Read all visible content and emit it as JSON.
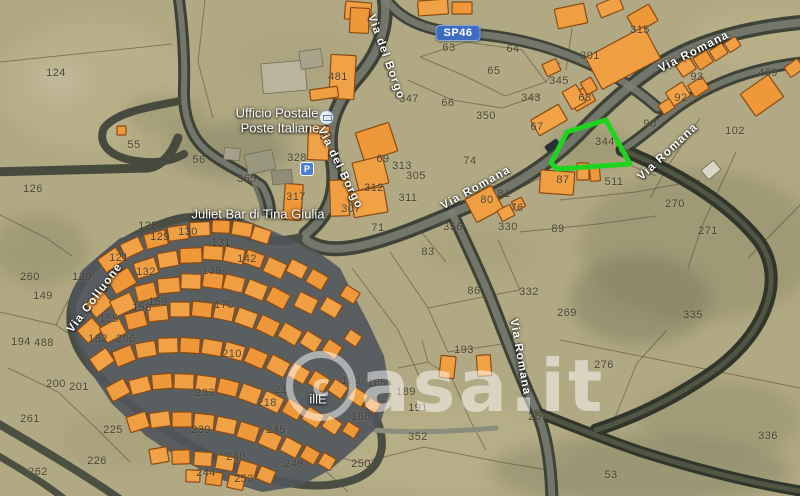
{
  "map": {
    "watermark": "casa.it",
    "route_badge": "SP46",
    "highlighted_parcel": "344",
    "parking_icon_letter": "P",
    "colors": {
      "terrain": "#b1a983",
      "road_dark": "#3f4337",
      "building_orange": "#f09e42",
      "building_outline": "#8a4a12",
      "highlight_green": "#1fd41f",
      "badge_blue": "#3c6cc2"
    },
    "poi_labels": [
      {
        "text": "Ufficio Postale",
        "x": 277,
        "y": 113
      },
      {
        "text": "Poste Italiane",
        "x": 280,
        "y": 128
      },
      {
        "text": "Juliet Bar di Tina Giulia",
        "x": 258,
        "y": 214
      },
      {
        "text": "illE",
        "x": 318,
        "y": 399
      }
    ],
    "street_labels": [
      {
        "text": "Via del Borgo",
        "x": 386,
        "y": 57,
        "rot": 70
      },
      {
        "text": "Via del Borgo",
        "x": 340,
        "y": 168,
        "rot": 64
      },
      {
        "text": "Via Romana",
        "x": 694,
        "y": 52,
        "rot": -27
      },
      {
        "text": "Via Romana",
        "x": 476,
        "y": 188,
        "rot": -29
      },
      {
        "text": "Via Romana",
        "x": 668,
        "y": 152,
        "rot": -43
      },
      {
        "text": "Via Romana",
        "x": 520,
        "y": 357,
        "rot": 80
      },
      {
        "text": "Via Colluone",
        "x": 95,
        "y": 298,
        "rot": -53
      }
    ],
    "parcel_labels": [
      {
        "n": "124",
        "x": 56,
        "y": 73
      },
      {
        "n": "55",
        "x": 134,
        "y": 145
      },
      {
        "n": "56",
        "x": 199,
        "y": 160
      },
      {
        "n": "126",
        "x": 33,
        "y": 189
      },
      {
        "n": "260",
        "x": 30,
        "y": 277
      },
      {
        "n": "149",
        "x": 43,
        "y": 296
      },
      {
        "n": "194",
        "x": 21,
        "y": 342
      },
      {
        "n": "488",
        "x": 44,
        "y": 343
      },
      {
        "n": "200",
        "x": 56,
        "y": 384
      },
      {
        "n": "201",
        "x": 79,
        "y": 387
      },
      {
        "n": "261",
        "x": 30,
        "y": 419
      },
      {
        "n": "225",
        "x": 113,
        "y": 430
      },
      {
        "n": "226",
        "x": 97,
        "y": 461
      },
      {
        "n": "262",
        "x": 38,
        "y": 472
      },
      {
        "n": "128",
        "x": 148,
        "y": 226
      },
      {
        "n": "129",
        "x": 160,
        "y": 237
      },
      {
        "n": "130",
        "x": 188,
        "y": 232
      },
      {
        "n": "131",
        "x": 221,
        "y": 243
      },
      {
        "n": "142",
        "x": 247,
        "y": 259
      },
      {
        "n": "121",
        "x": 119,
        "y": 258
      },
      {
        "n": "120",
        "x": 82,
        "y": 277
      },
      {
        "n": "132",
        "x": 146,
        "y": 272
      },
      {
        "n": "139",
        "x": 212,
        "y": 271
      },
      {
        "n": "155",
        "x": 109,
        "y": 319
      },
      {
        "n": "158",
        "x": 142,
        "y": 308
      },
      {
        "n": "159",
        "x": 158,
        "y": 302
      },
      {
        "n": "170",
        "x": 224,
        "y": 305
      },
      {
        "n": "182",
        "x": 98,
        "y": 339
      },
      {
        "n": "206",
        "x": 126,
        "y": 339
      },
      {
        "n": "210",
        "x": 232,
        "y": 354
      },
      {
        "n": "217",
        "x": 284,
        "y": 390
      },
      {
        "n": "218",
        "x": 267,
        "y": 403
      },
      {
        "n": "233",
        "x": 205,
        "y": 393
      },
      {
        "n": "239",
        "x": 201,
        "y": 430
      },
      {
        "n": "240",
        "x": 236,
        "y": 457
      },
      {
        "n": "244",
        "x": 206,
        "y": 473
      },
      {
        "n": "245",
        "x": 276,
        "y": 430
      },
      {
        "n": "249",
        "x": 294,
        "y": 464
      },
      {
        "n": "253",
        "x": 244,
        "y": 479
      },
      {
        "n": "250",
        "x": 361,
        "y": 464
      },
      {
        "n": "481",
        "x": 338,
        "y": 77
      },
      {
        "n": "347",
        "x": 409,
        "y": 99
      },
      {
        "n": "66",
        "x": 448,
        "y": 103
      },
      {
        "n": "350",
        "x": 486,
        "y": 116
      },
      {
        "n": "63",
        "x": 449,
        "y": 48
      },
      {
        "n": "64",
        "x": 513,
        "y": 49
      },
      {
        "n": "65",
        "x": 494,
        "y": 71
      },
      {
        "n": "343",
        "x": 531,
        "y": 98
      },
      {
        "n": "345",
        "x": 559,
        "y": 81
      },
      {
        "n": "301",
        "x": 590,
        "y": 56
      },
      {
        "n": "67",
        "x": 537,
        "y": 127
      },
      {
        "n": "68",
        "x": 585,
        "y": 98
      },
      {
        "n": "315",
        "x": 640,
        "y": 30
      },
      {
        "n": "93",
        "x": 697,
        "y": 77
      },
      {
        "n": "92",
        "x": 681,
        "y": 98
      },
      {
        "n": "469",
        "x": 768,
        "y": 73
      },
      {
        "n": "90",
        "x": 650,
        "y": 124
      },
      {
        "n": "102",
        "x": 735,
        "y": 131
      },
      {
        "n": "344",
        "x": 605,
        "y": 142
      },
      {
        "n": "87",
        "x": 563,
        "y": 180
      },
      {
        "n": "511",
        "x": 614,
        "y": 182
      },
      {
        "n": "89",
        "x": 558,
        "y": 229
      },
      {
        "n": "50",
        "x": 326,
        "y": 136
      },
      {
        "n": "328",
        "x": 297,
        "y": 158
      },
      {
        "n": "365",
        "x": 247,
        "y": 179
      },
      {
        "n": "317",
        "x": 296,
        "y": 197
      },
      {
        "n": "69",
        "x": 383,
        "y": 159
      },
      {
        "n": "312",
        "x": 374,
        "y": 188
      },
      {
        "n": "313",
        "x": 402,
        "y": 166
      },
      {
        "n": "305",
        "x": 416,
        "y": 176
      },
      {
        "n": "311",
        "x": 408,
        "y": 198
      },
      {
        "n": "307",
        "x": 351,
        "y": 209
      },
      {
        "n": "71",
        "x": 378,
        "y": 228
      },
      {
        "n": "74",
        "x": 470,
        "y": 161
      },
      {
        "n": "80",
        "x": 487,
        "y": 200
      },
      {
        "n": "81",
        "x": 504,
        "y": 194
      },
      {
        "n": "76",
        "x": 517,
        "y": 208
      },
      {
        "n": "356",
        "x": 453,
        "y": 227
      },
      {
        "n": "330",
        "x": 508,
        "y": 227
      },
      {
        "n": "83",
        "x": 428,
        "y": 252
      },
      {
        "n": "86",
        "x": 474,
        "y": 291
      },
      {
        "n": "332",
        "x": 529,
        "y": 292
      },
      {
        "n": "193",
        "x": 464,
        "y": 350
      },
      {
        "n": "183",
        "x": 351,
        "y": 381
      },
      {
        "n": "185",
        "x": 377,
        "y": 383
      },
      {
        "n": "189",
        "x": 406,
        "y": 392
      },
      {
        "n": "191",
        "x": 418,
        "y": 408
      },
      {
        "n": "186",
        "x": 361,
        "y": 417
      },
      {
        "n": "352",
        "x": 418,
        "y": 437
      },
      {
        "n": "270",
        "x": 675,
        "y": 204
      },
      {
        "n": "271",
        "x": 708,
        "y": 231
      },
      {
        "n": "335",
        "x": 693,
        "y": 315
      },
      {
        "n": "269",
        "x": 567,
        "y": 313
      },
      {
        "n": "267",
        "x": 538,
        "y": 417
      },
      {
        "n": "276",
        "x": 604,
        "y": 365
      },
      {
        "n": "336",
        "x": 768,
        "y": 436
      },
      {
        "n": "53",
        "x": 611,
        "y": 475
      }
    ]
  }
}
